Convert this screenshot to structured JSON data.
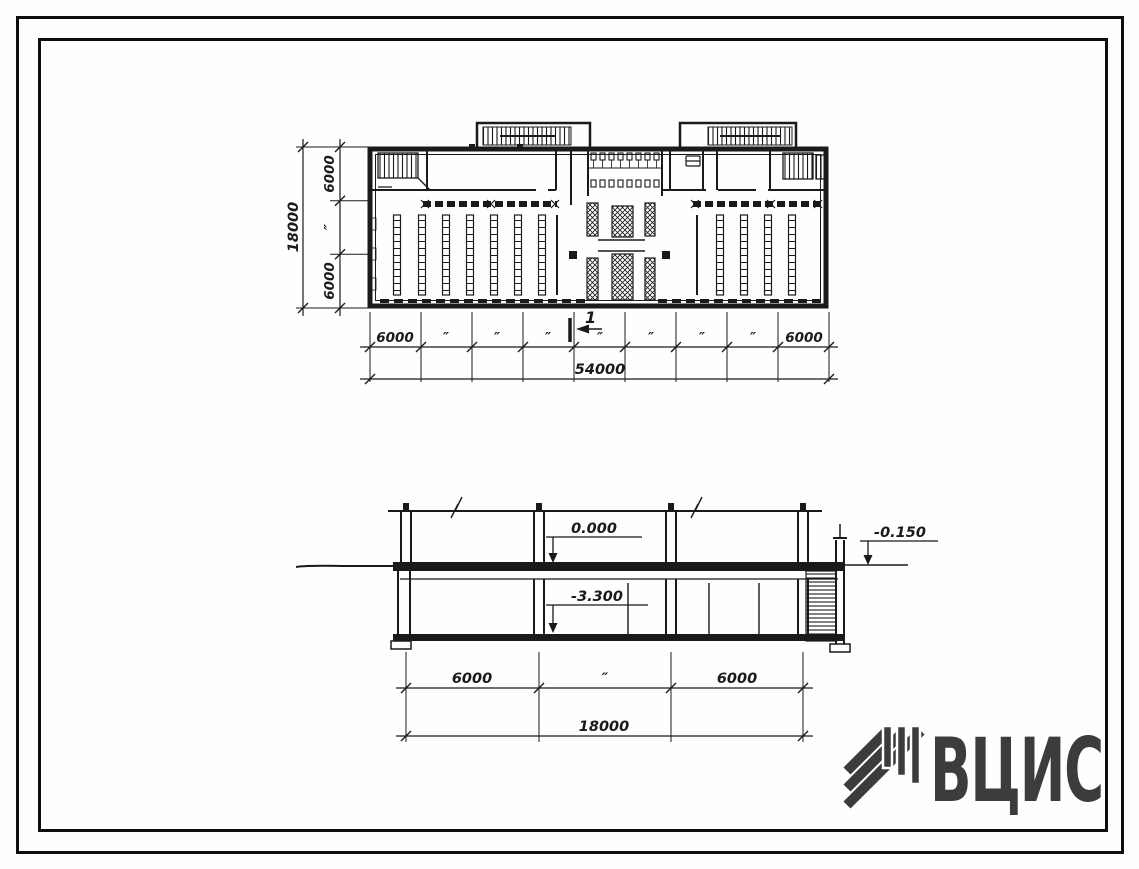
{
  "colors": {
    "ink": "#1a1a1c",
    "paper": "#fefefe",
    "logo": "#3c3c3e"
  },
  "plan": {
    "left_dims": {
      "bays": [
        "6000",
        "″",
        "6000"
      ],
      "total": "18000"
    },
    "bottom_dims": {
      "bays": [
        "6000",
        "″",
        "″",
        "″",
        "″",
        "″",
        "″",
        "″",
        "6000"
      ],
      "total": "54000"
    },
    "section_mark": "1"
  },
  "section": {
    "elevations": {
      "floor": "0.000",
      "basement": "-3.300",
      "grade": "-0.150"
    },
    "bottom_dims": {
      "bays": [
        "6000",
        "″",
        "6000"
      ],
      "total": "18000"
    }
  },
  "logo": {
    "text": "ВЦИС"
  }
}
